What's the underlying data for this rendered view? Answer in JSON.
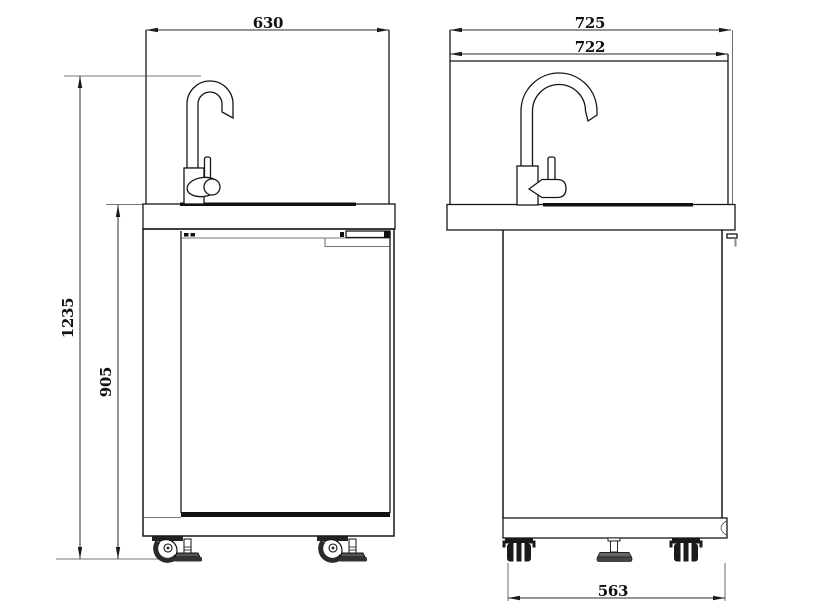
{
  "drawing": {
    "kind": "sink-cabinet-technical-drawing",
    "background": "#ffffff",
    "line_color": "#161616"
  },
  "views": {
    "front": {
      "label": "front-view",
      "dims": {
        "width": "630",
        "overall_height": "1235",
        "cabinet_height": "905"
      }
    },
    "side": {
      "label": "side-view",
      "dims": {
        "overall_depth": "725",
        "top_depth": "722",
        "base_depth": "563"
      }
    }
  }
}
